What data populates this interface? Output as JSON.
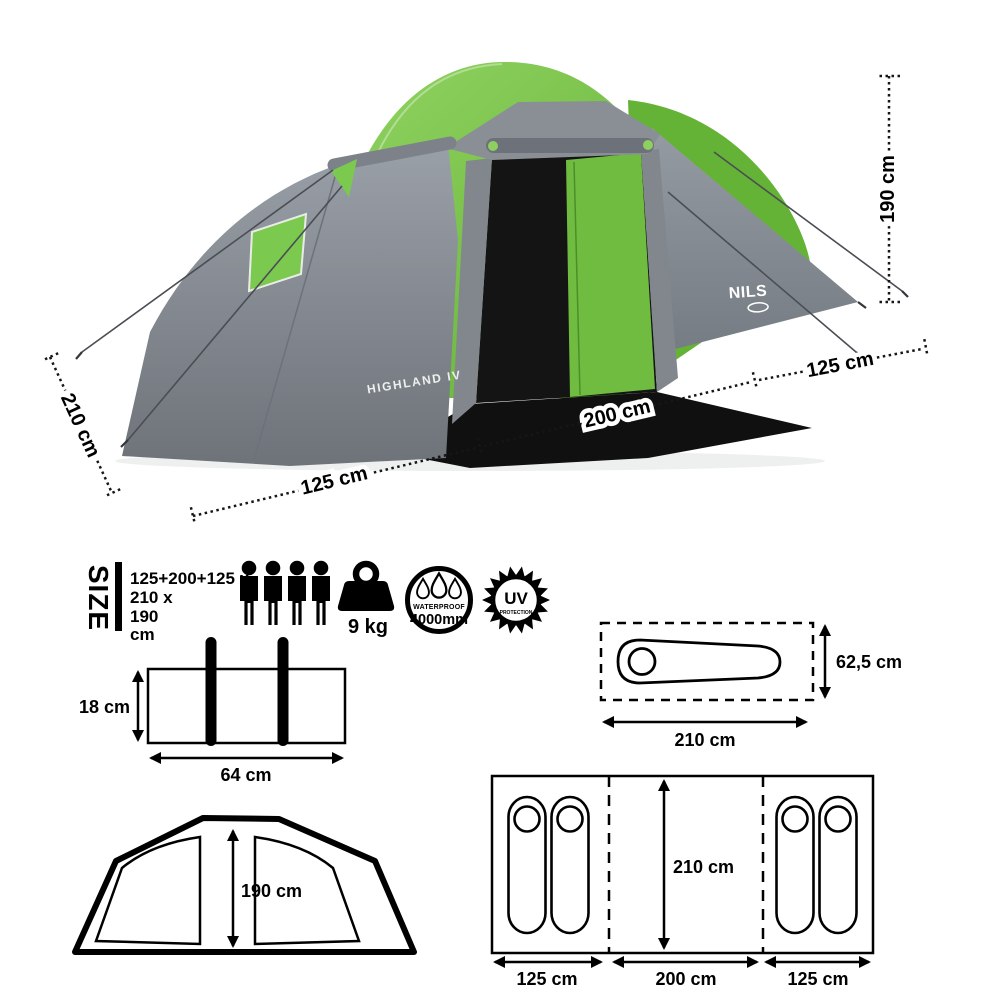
{
  "product": {
    "brand": "NILS",
    "model": "HIGHLAND IV"
  },
  "colors": {
    "green": "#72bf44",
    "green_light": "#92d463",
    "green_dark": "#5fae31",
    "gray_light": "#9aa0a7",
    "gray_dark": "#6e737a",
    "ink": "#000000"
  },
  "main_diagram": {
    "height_label": "190 cm",
    "depth_label": "210 cm",
    "left_width_label": "125 cm",
    "center_width_label": "200 cm",
    "right_width_label": "125 cm"
  },
  "size_panel": {
    "title": "SIZE",
    "spec_lines": [
      "125+200+125 x",
      "210 x",
      "190",
      "cm"
    ],
    "capacity_persons": 4,
    "weight_label": "9 kg",
    "waterproof": {
      "label": "WATERPROOF",
      "value": "4000mm"
    },
    "uv": {
      "label": "UV",
      "sublabel": "PROTECTION"
    }
  },
  "packed_size": {
    "width_label": "64 cm",
    "height_label": "18 cm"
  },
  "front_view": {
    "height_label": "190 cm"
  },
  "sleeping_bag": {
    "length_label": "210 cm",
    "width_label": "62,5 cm"
  },
  "floor_plan": {
    "left_label": "125 cm",
    "center_label": "200 cm",
    "right_label": "125 cm",
    "depth_label": "210 cm"
  }
}
